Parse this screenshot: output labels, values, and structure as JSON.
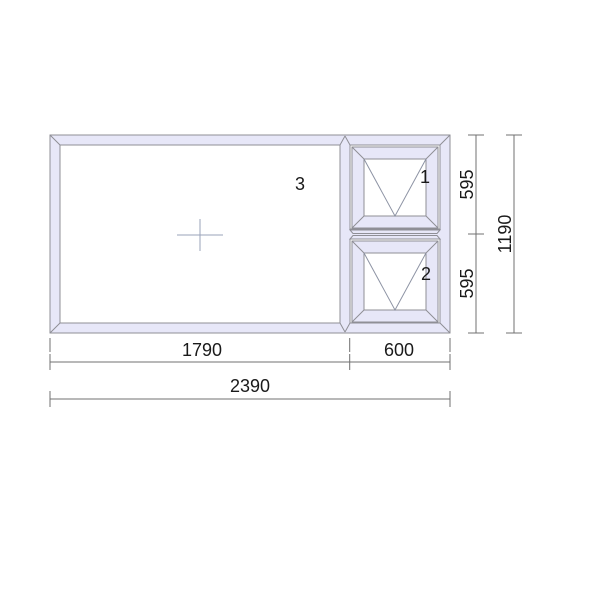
{
  "page": {
    "background": "#ffffff"
  },
  "drawing": {
    "type": "window-elevation-technical-drawing",
    "pane_labels": {
      "fixed": "3",
      "top_sash": "1",
      "bottom_sash": "2"
    },
    "dimensions": {
      "width_left": "1790",
      "width_right": "600",
      "width_total": "2390",
      "height_top": "595",
      "height_bottom": "595",
      "height_total": "1190"
    }
  },
  "colors": {
    "frame_fill": "#e7e7f8",
    "frame_stroke": "#8f8f96",
    "glass_fill": "#ffffff",
    "opening_indicator": "#8d93a4",
    "center_mark": "#9aa3ba",
    "dimension_line": "#707070",
    "text_color": "#1a1a1a"
  }
}
